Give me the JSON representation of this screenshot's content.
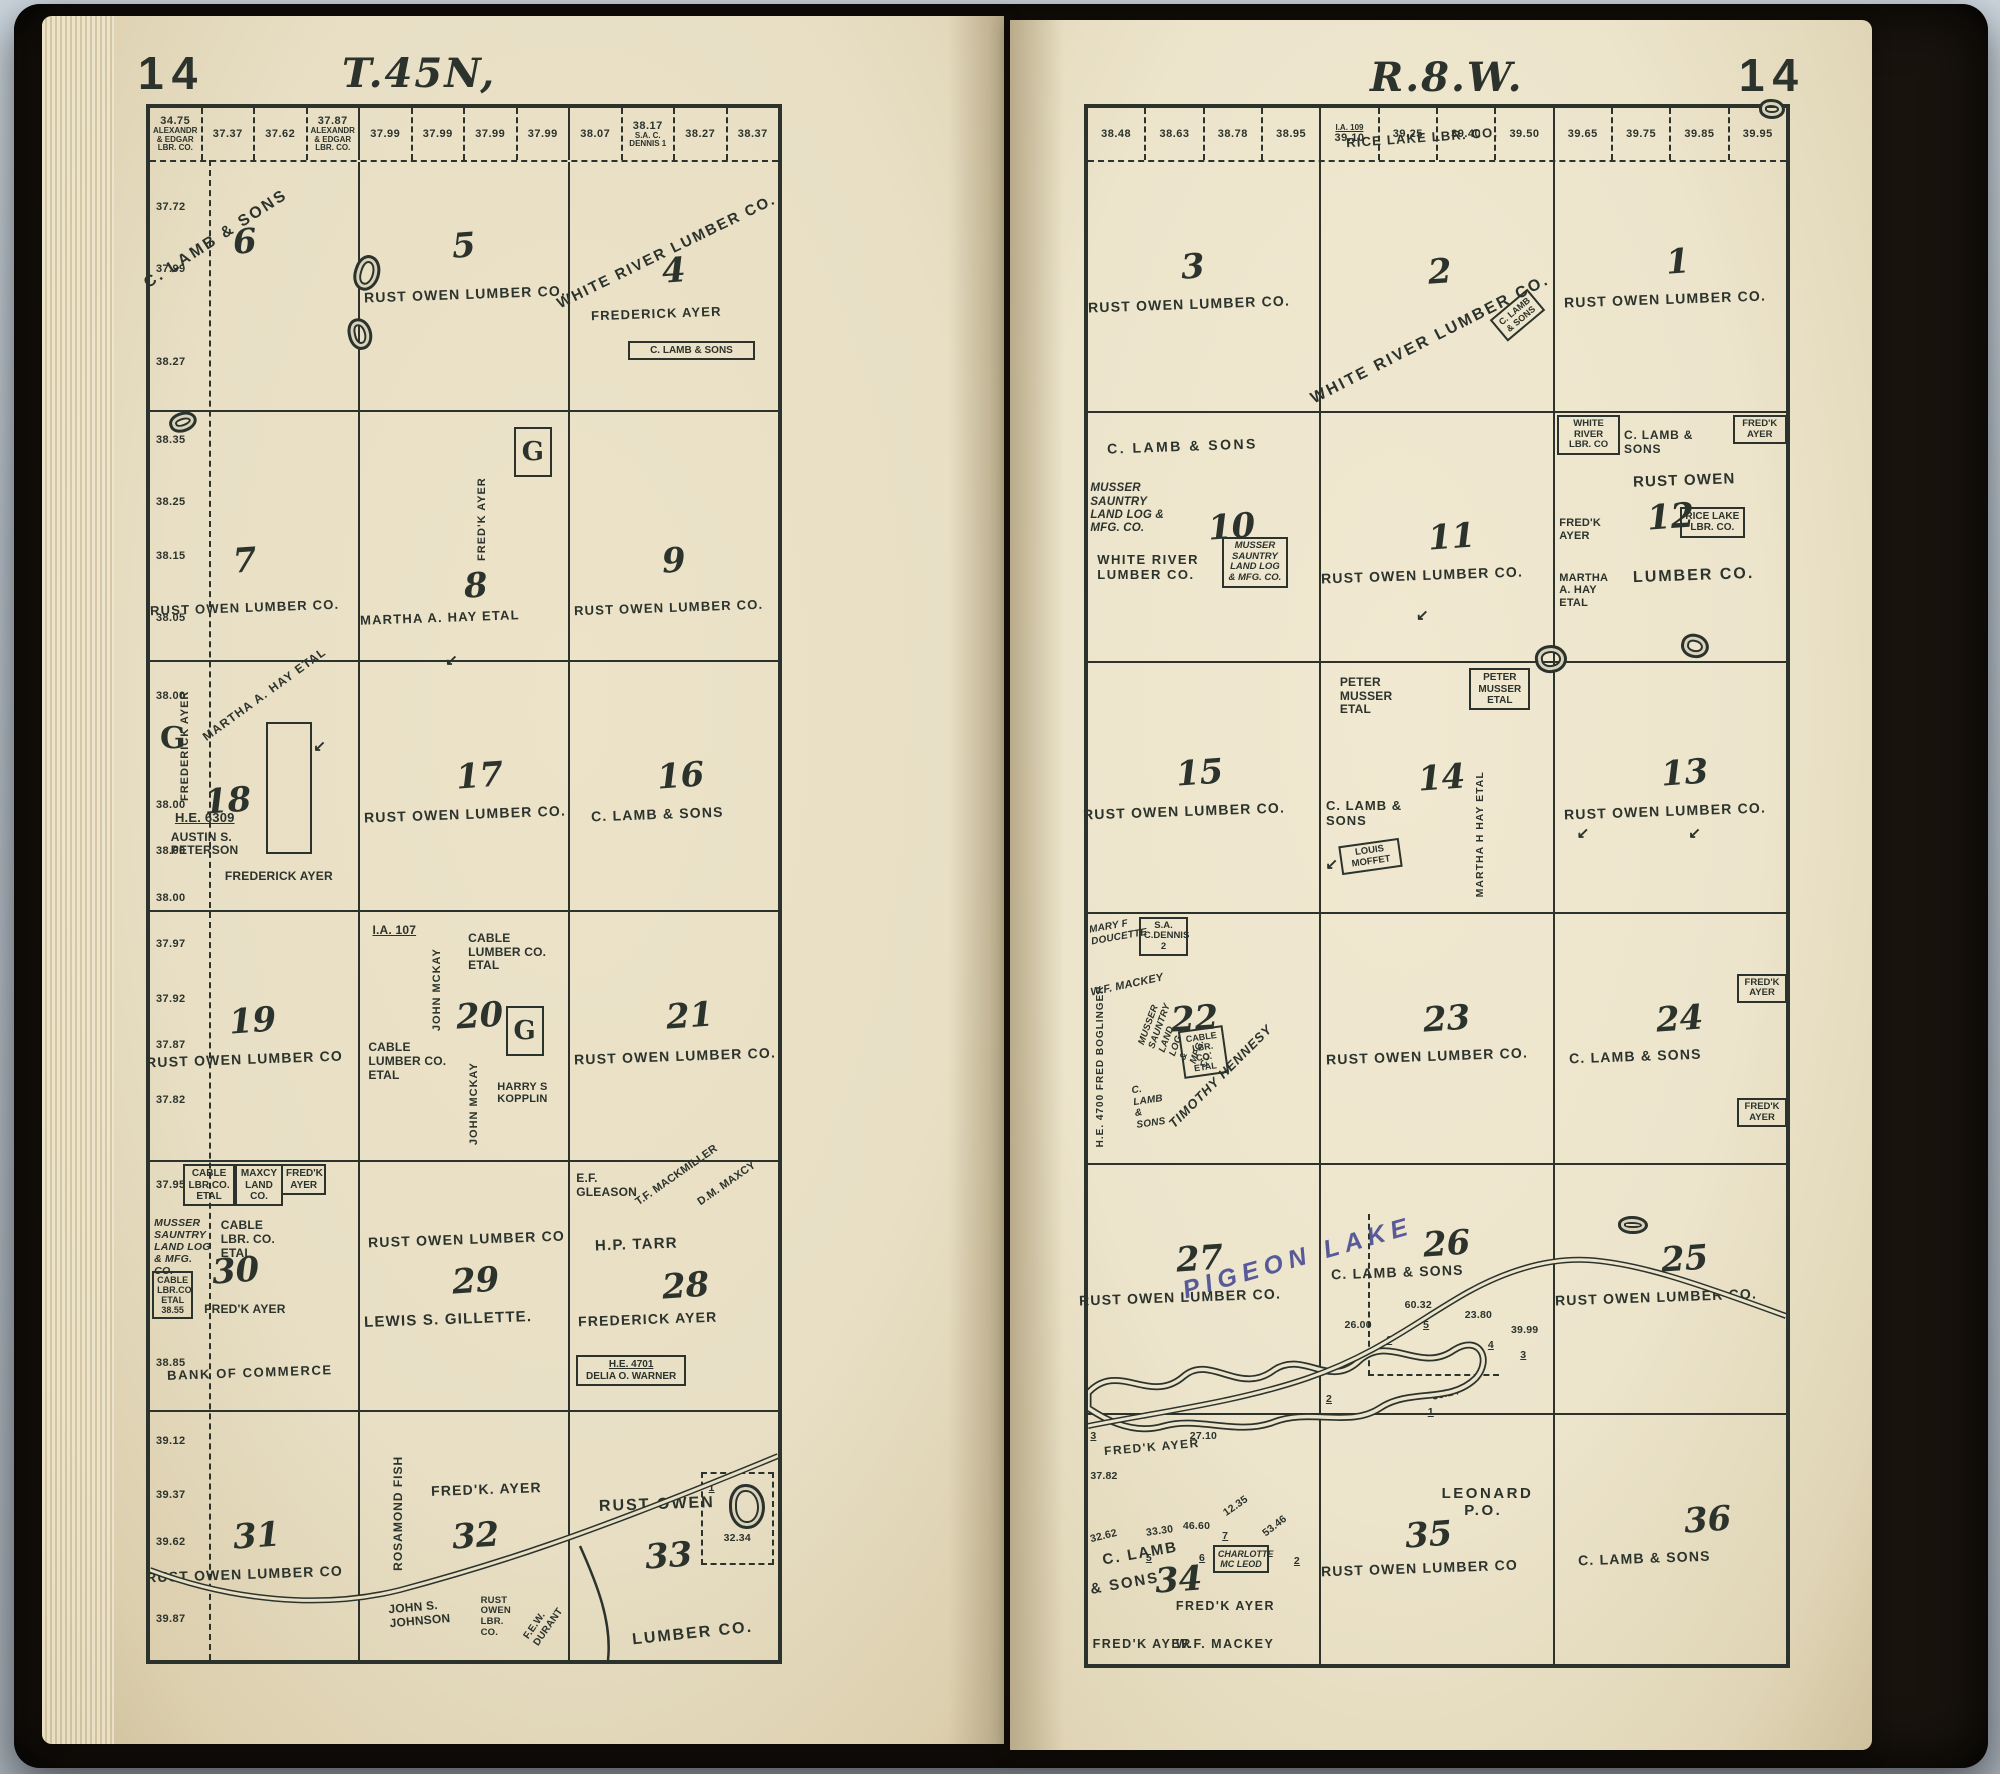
{
  "photo": {
    "background": "#ccd6de",
    "cover": "#18130d",
    "ink": "#2b332c",
    "blue_ink": "#3e4290"
  },
  "left": {
    "page_number": "14",
    "township": "T.45N,",
    "top": [
      {
        "a": "34.75",
        "o": "ALEXANDR & EDGAR LBR. CO."
      },
      {
        "a": "37.37",
        "o": ""
      },
      {
        "a": "37.62",
        "o": ""
      },
      {
        "a": "37.87",
        "o": "ALEXANDR & EDGAR LBR. CO."
      },
      {
        "a": "37.99",
        "o": ""
      },
      {
        "a": "37.99",
        "o": ""
      },
      {
        "a": "37.99",
        "o": ""
      },
      {
        "a": "37.99",
        "o": ""
      },
      {
        "a": "38.07",
        "o": ""
      },
      {
        "a": "38.17",
        "o": "S.A. C. DENNIS 1"
      },
      {
        "a": "38.27",
        "o": ""
      },
      {
        "a": "38.37",
        "o": ""
      }
    ],
    "edge": [
      "37.72",
      "37.99",
      "38.27",
      "38.35",
      "38.25",
      "38.15",
      "38.05",
      "38.00",
      "38.00",
      "38.00",
      "38.00",
      "37.97",
      "37.92",
      "37.87",
      "37.82",
      "37.95",
      "38.85",
      "39.12",
      "39.37",
      "39.62",
      "39.87"
    ],
    "edge_g": "G",
    "s6": {
      "num": "6",
      "owner": "C. LAMB & SONS"
    },
    "s5": {
      "num": "5",
      "owner": "RUST OWEN LUMBER CO."
    },
    "s4": {
      "num": "4",
      "diag": "WHITE RIVER LUMBER CO.",
      "owner": "FREDERICK AYER",
      "sub": "C. LAMB & SONS"
    },
    "s7": {
      "num": "7",
      "owner": "RUST OWEN LUMBER CO."
    },
    "s8": {
      "num": "8",
      "owner": "MARTHA A. HAY ETAL",
      "vert": "FRED'K AYER",
      "g": "G"
    },
    "s9": {
      "num": "9",
      "owner": "RUST OWEN LUMBER CO."
    },
    "s18": {
      "num": "18",
      "vert": "FREDERICK AYER",
      "diag": "MARTHA A. HAY ETAL",
      "he": "H.E. 6309",
      "sub1": "AUSTIN S. PETERSON",
      "sub2": "FREDERICK AYER"
    },
    "s17": {
      "num": "17",
      "owner": "RUST OWEN LUMBER CO."
    },
    "s16": {
      "num": "16",
      "owner": "C. LAMB & SONS"
    },
    "s19": {
      "num": "19",
      "owner": "RUST OWEN LUMBER CO"
    },
    "s20": {
      "num": "20",
      "ia": "I.A. 107",
      "vert1": "JOHN MCKAY",
      "sub1": "CABLE LUMBER CO. ETAL",
      "sub2": "CABLE LUMBER CO. ETAL",
      "vert2": "JOHN MCKAY",
      "g": "G",
      "sub3": "HARRY S KOPPLIN"
    },
    "s21": {
      "num": "21",
      "owner": "RUST OWEN LUMBER CO."
    },
    "s30": {
      "num": "30",
      "t1": "CABLE LBR.CO. ETAL",
      "t2": "MAXCY LAND CO.",
      "t3": "FRED'K AYER",
      "m1": "MUSSER SAUNTRY LAND LOG & MFG. CO.",
      "m2": "CABLE LBR. CO. ETAL",
      "m3": "CABLE LBR.CO ETAL 38.55",
      "m4": "FRED'K AYER",
      "bottom": "BANK OF COMMERCE"
    },
    "s29": {
      "num": "29",
      "owner": "RUST OWEN LUMBER CO",
      "owner2": "LEWIS S. GILLETTE."
    },
    "s28": {
      "num": "28",
      "t1": "E.F. GLEASON",
      "t2": "T.F. MACKMILLER",
      "t3": "D.M. MAXCY",
      "owner": "H.P. TARR",
      "owner2": "FREDERICK AYER",
      "he": "H.E. 4701",
      "he2": "DELIA O. WARNER"
    },
    "s31": {
      "num": "31",
      "owner": "RUST OWEN LUMBER CO"
    },
    "s32": {
      "num": "32",
      "vert": "ROSAMOND FISH",
      "owner": "FRED'K. AYER",
      "b1": "JOHN S. JOHNSON",
      "b2": "RUST OWEN LBR. CO.",
      "b3": "F.E.W. DURANT"
    },
    "s33": {
      "num": "33",
      "owner": "RUST OWEN",
      "owner2": "LUMBER CO.",
      "lot": "1",
      "lake_acre": "32.34"
    }
  },
  "right": {
    "page_number": "14",
    "range": "R.8.W.",
    "top": [
      {
        "a": "38.48",
        "o": ""
      },
      {
        "a": "38.63",
        "o": ""
      },
      {
        "a": "38.78",
        "o": ""
      },
      {
        "a": "38.95",
        "o": ""
      },
      {
        "a": "39.10",
        "o": "I.A. 109"
      },
      {
        "a": "39.25",
        "o": ""
      },
      {
        "a": "39.40",
        "o": ""
      },
      {
        "a": "39.50",
        "o": ""
      },
      {
        "a": "39.65",
        "o": ""
      },
      {
        "a": "39.75",
        "o": ""
      },
      {
        "a": "39.85",
        "o": ""
      },
      {
        "a": "39.95",
        "o": ""
      }
    ],
    "rice": "RICE LAKE LBR. CO.",
    "lake_label": "PIGEON LAKE",
    "s3": {
      "num": "3",
      "owner": "RUST OWEN LUMBER CO."
    },
    "s2": {
      "num": "2",
      "diag": "WHITE RIVER LUMBER CO.",
      "sub": "C. LAMB & SONS"
    },
    "s1": {
      "num": "1",
      "owner": "RUST OWEN LUMBER CO."
    },
    "s10": {
      "num": "10",
      "top": "C. LAMB & SONS",
      "m1": "MUSSER SAUNTRY LAND LOG & MFG. CO.",
      "owner": "WHITE RIVER LUMBER CO.",
      "m2": "MUSSER SAUNTRY LAND LOG & MFG. CO."
    },
    "s11": {
      "num": "11",
      "owner": "RUST OWEN LUMBER CO."
    },
    "s12": {
      "num": "12",
      "l1": "WHITE RIVER LBR. CO",
      "l2": "FRED'K AYER",
      "l3": "MARTHA A. HAY ETAL",
      "t1": "C. LAMB & SONS",
      "t2": "FRED'K AYER",
      "owner": "RUST OWEN",
      "box": "RICE LAKE LBR. CO.",
      "owner2": "LUMBER CO."
    },
    "s15": {
      "num": "15",
      "owner": "RUST OWEN LUMBER CO."
    },
    "s14": {
      "num": "14",
      "t1": "PETER MUSSER ETAL",
      "t2": "PETER MUSSER ETAL",
      "owner": "C. LAMB & SONS",
      "sub": "LOUIS MOFFET",
      "vert": "MARTHA H HAY ETAL"
    },
    "s13": {
      "num": "13",
      "owner": "RUST OWEN LUMBER CO."
    },
    "s22": {
      "num": "22",
      "b1": "MARY F DOUCETTE",
      "b2": "S.A. C.DENNIS 2",
      "b3": "W.F. MACKEY",
      "b4": "H.E. 4700 FRED BOGLINGER",
      "b5": "MUSSER SAUNTRY LAND LOG & MFG. CO.",
      "b6": "CABLE LBR. CO. ETAL",
      "b7": "C. LAMB & SONS",
      "diag": "TIMOTHY HENNESY"
    },
    "s23": {
      "num": "23",
      "owner": "RUST OWEN LUMBER CO."
    },
    "s24": {
      "num": "24",
      "owner": "C. LAMB & SONS",
      "r1": "FRED'K AYER",
      "r2": "FRED'K AYER"
    },
    "s27": {
      "num": "27",
      "owner": "RUST OWEN LUMBER CO."
    },
    "s26": {
      "num": "26",
      "owner": "C. LAMB & SONS",
      "v1": "60.32",
      "l1": "5",
      "v2": "26.00",
      "l2": "6",
      "v3": "23.80",
      "l3": "4",
      "v4": "39.99",
      "l4": "3",
      "v5": "38.14",
      "l5": "1",
      "l6": "2"
    },
    "s25": {
      "num": "25",
      "owner": "RUST OWEN LUMBER CO."
    },
    "s34": {
      "num": "34",
      "n3": "3",
      "t1": "FRED'K AYER",
      "a1": "37.82",
      "t2": "27.10",
      "diag1": "C. LAMB",
      "diag2": "& SONS",
      "v1": "32.62",
      "v2": "33.30",
      "l1": "5",
      "v3": "46.60",
      "l2": "6",
      "v4": "12.35",
      "l3": "7",
      "sub1": "CHARLOTTE MC LEOD",
      "v5": "53.46",
      "l4": "2",
      "sub2": "FRED'K AYER",
      "b1": "FRED'K AYER",
      "b2": "W.F. MACKEY"
    },
    "s35": {
      "num": "35",
      "po": "LEONARD P.O.",
      "owner": "RUST OWEN LUMBER CO"
    },
    "s36": {
      "num": "36",
      "owner": "C. LAMB & SONS"
    }
  }
}
